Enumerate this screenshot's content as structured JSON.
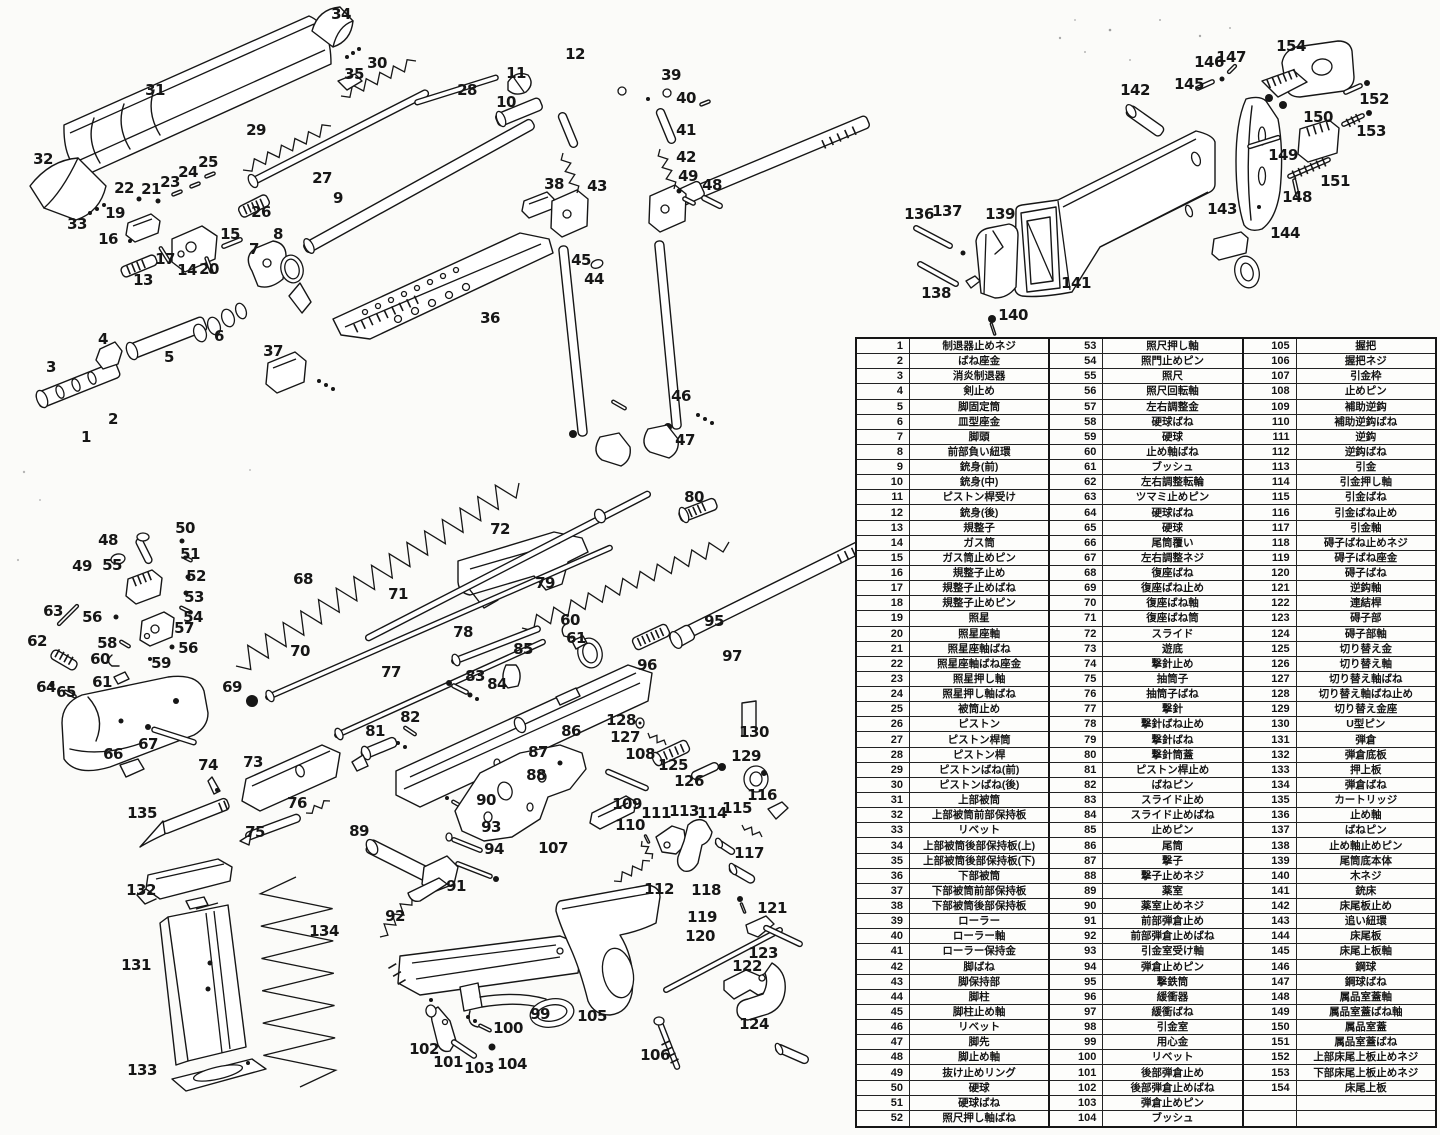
{
  "page": {
    "background": "#fbfbf9",
    "ink_color": "#161616"
  },
  "parts_table": {
    "columns": 3,
    "rows_per_column": 52,
    "empty_trailing_rows": 2,
    "entries": [
      "制退器止めネジ",
      "ばね座金",
      "消炎制退器",
      "剣止め",
      "脚固定筒",
      "皿型座金",
      "脚頭",
      "前部負い紐環",
      "銃身(前)",
      "銃身(中)",
      "ピストン桿受け",
      "銃身(後)",
      "規整子",
      "ガス筒",
      "ガス筒止めピン",
      "規整子止め",
      "規整子止めばね",
      "規整子止めピン",
      "照星",
      "照星座軸",
      "照星座軸ばね",
      "照星座軸ばね座金",
      "照星押し軸",
      "照星押し軸ばね",
      "被筒止め",
      "ピストン",
      "ピストン桿筒",
      "ピストン桿",
      "ピストンばね(前)",
      "ピストンばね(後)",
      "上部被筒",
      "上部被筒前部保持板",
      "リベット",
      "上部被筒後部保持板(上)",
      "上部被筒後部保持板(下)",
      "下部被筒",
      "下部被筒前部保持板",
      "下部被筒後部保持板",
      "ローラー",
      "ローラー軸",
      "ローラー保持金",
      "脚ばね",
      "脚保持部",
      "脚柱",
      "脚柱止め軸",
      "リベット",
      "脚先",
      "脚止め軸",
      "抜け止めリング",
      "硬球",
      "硬球ばね",
      "照尺押し軸ばね",
      "照尺押し軸",
      "照門止めピン",
      "照尺",
      "照尺回転軸",
      "左右調整金",
      "硬球ばね",
      "硬球",
      "止め軸ばね",
      "ブッシュ",
      "左右調整転輪",
      "ツマミ止めピン",
      "硬球ばね",
      "硬球",
      "尾筒覆い",
      "左右調整ネジ",
      "復座ばね",
      "復座ばね止め",
      "復座ばね軸",
      "復座ばね筒",
      "スライド",
      "遊底",
      "撃針止め",
      "抽筒子",
      "抽筒子ばね",
      "撃針",
      "撃針ばね止め",
      "撃針ばね",
      "撃針筒蓋",
      "ピストン桿止め",
      "ばねピン",
      "スライド止め",
      "スライド止めばね",
      "止めピン",
      "尾筒",
      "撃子",
      "撃子止めネジ",
      "薬室",
      "薬室止めネジ",
      "前部弾倉止め",
      "前部弾倉止めばね",
      "引金室受け軸",
      "弾倉止めピン",
      "撃鉄筒",
      "緩衝器",
      "緩衝ばね",
      "引金室",
      "用心金",
      "リベット",
      "後部弾倉止め",
      "後部弾倉止めばね",
      "弾倉止めピン",
      "ブッシュ",
      "握把",
      "握把ネジ",
      "引金枠",
      "止めピン",
      "補助逆鈎",
      "補助逆鈎ばね",
      "逆鈎",
      "逆鈎ばね",
      "引金",
      "引金押し軸",
      "引金ばね",
      "引金ばね止め",
      "引金軸",
      "碍子ばね止めネジ",
      "碍子ばね座金",
      "碍子ばね",
      "逆鈎軸",
      "連結桿",
      "碍子部",
      "碍子部軸",
      "切り替え金",
      "切り替え軸",
      "切り替え軸ばね",
      "切り替え軸ばね止め",
      "切り替え金座",
      "U型ピン",
      "弾倉",
      "弾倉底板",
      "押上板",
      "弾倉ばね",
      "カートリッジ",
      "止め軸",
      "ばねピン",
      "止め軸止めピン",
      "尾筒底本体",
      "木ネジ",
      "銃床",
      "床尾板止め",
      "追い紐環",
      "床尾板",
      "床尾上板軸",
      "鋼球",
      "鋼球ばね",
      "属品室蓋軸",
      "属品室蓋ばね軸",
      "属品室蓋",
      "属品室蓋ばね",
      "上部床尾上板止めネジ",
      "下部床尾上板止めネジ",
      "床尾上板"
    ]
  },
  "diagram": {
    "labels": [
      [
        1,
        86,
        437
      ],
      [
        2,
        113,
        419
      ],
      [
        3,
        51,
        367
      ],
      [
        4,
        103,
        339
      ],
      [
        5,
        169,
        357
      ],
      [
        6,
        219,
        336
      ],
      [
        7,
        254,
        249
      ],
      [
        8,
        278,
        234
      ],
      [
        9,
        338,
        198
      ],
      [
        10,
        506,
        102
      ],
      [
        11,
        516,
        73
      ],
      [
        12,
        575,
        54
      ],
      [
        13,
        143,
        280
      ],
      [
        14,
        187,
        270
      ],
      [
        15,
        230,
        234
      ],
      [
        16,
        108,
        239
      ],
      [
        17,
        165,
        259
      ],
      [
        19,
        115,
        213
      ],
      [
        20,
        209,
        269
      ],
      [
        21,
        151,
        189
      ],
      [
        22,
        124,
        188
      ],
      [
        23,
        170,
        182
      ],
      [
        24,
        188,
        172
      ],
      [
        25,
        208,
        162
      ],
      [
        26,
        261,
        212
      ],
      [
        27,
        322,
        178
      ],
      [
        28,
        467,
        90
      ],
      [
        29,
        256,
        130
      ],
      [
        30,
        377,
        63
      ],
      [
        31,
        155,
        90
      ],
      [
        32,
        43,
        159
      ],
      [
        33,
        77,
        224
      ],
      [
        34,
        341,
        14
      ],
      [
        35,
        354,
        74
      ],
      [
        36,
        490,
        318
      ],
      [
        37,
        273,
        351
      ],
      [
        38,
        554,
        184
      ],
      [
        39,
        671,
        75
      ],
      [
        40,
        686,
        98
      ],
      [
        41,
        686,
        130
      ],
      [
        42,
        686,
        157
      ],
      [
        43,
        597,
        186
      ],
      [
        44,
        594,
        279
      ],
      [
        45,
        581,
        260
      ],
      [
        46,
        681,
        396
      ],
      [
        47,
        685,
        440
      ],
      [
        48,
        712,
        185
      ],
      [
        49,
        688,
        176
      ],
      [
        136,
        919,
        214
      ],
      [
        137,
        947,
        211
      ],
      [
        138,
        936,
        293
      ],
      [
        139,
        1000,
        214
      ],
      [
        140,
        1013,
        315
      ],
      [
        141,
        1076,
        283
      ],
      [
        142,
        1135,
        90
      ],
      [
        143,
        1222,
        209
      ],
      [
        144,
        1285,
        233
      ],
      [
        145,
        1189,
        84
      ],
      [
        146,
        1209,
        62
      ],
      [
        147,
        1231,
        57
      ],
      [
        148,
        1297,
        197
      ],
      [
        149,
        1283,
        155
      ],
      [
        150,
        1318,
        117
      ],
      [
        151,
        1335,
        181
      ],
      [
        152,
        1374,
        99
      ],
      [
        153,
        1371,
        131
      ],
      [
        154,
        1291,
        46
      ],
      [
        48,
        108,
        540
      ],
      [
        49,
        82,
        566
      ],
      [
        50,
        185,
        528
      ],
      [
        51,
        190,
        554
      ],
      [
        52,
        196,
        576
      ],
      [
        53,
        194,
        597
      ],
      [
        54,
        193,
        617
      ],
      [
        55,
        112,
        565
      ],
      [
        56,
        92,
        617
      ],
      [
        56,
        188,
        648
      ],
      [
        57,
        184,
        628
      ],
      [
        58,
        107,
        643
      ],
      [
        59,
        161,
        663
      ],
      [
        60,
        100,
        659
      ],
      [
        60,
        570,
        620
      ],
      [
        61,
        102,
        682
      ],
      [
        61,
        576,
        638
      ],
      [
        62,
        37,
        641
      ],
      [
        63,
        53,
        611
      ],
      [
        64,
        46,
        687
      ],
      [
        65,
        66,
        692
      ],
      [
        66,
        113,
        754
      ],
      [
        67,
        148,
        744
      ],
      [
        68,
        303,
        579
      ],
      [
        69,
        232,
        687
      ],
      [
        70,
        300,
        651
      ],
      [
        71,
        398,
        594
      ],
      [
        72,
        500,
        529
      ],
      [
        73,
        253,
        762
      ],
      [
        74,
        208,
        765
      ],
      [
        75,
        255,
        832
      ],
      [
        76,
        297,
        803
      ],
      [
        77,
        391,
        672
      ],
      [
        78,
        463,
        632
      ],
      [
        79,
        545,
        583
      ],
      [
        80,
        694,
        497
      ],
      [
        81,
        375,
        731
      ],
      [
        82,
        410,
        717
      ],
      [
        83,
        475,
        676
      ],
      [
        84,
        497,
        684
      ],
      [
        85,
        523,
        649
      ],
      [
        86,
        571,
        731
      ],
      [
        87,
        538,
        752
      ],
      [
        88,
        536,
        775
      ],
      [
        89,
        359,
        831
      ],
      [
        90,
        486,
        800
      ],
      [
        91,
        456,
        886
      ],
      [
        92,
        395,
        916
      ],
      [
        93,
        491,
        827
      ],
      [
        94,
        494,
        849
      ],
      [
        95,
        714,
        621
      ],
      [
        96,
        647,
        665
      ],
      [
        97,
        732,
        656
      ],
      [
        99,
        540,
        1014
      ],
      [
        100,
        508,
        1028
      ],
      [
        101,
        448,
        1062
      ],
      [
        102,
        424,
        1049
      ],
      [
        103,
        479,
        1068
      ],
      [
        104,
        512,
        1064
      ],
      [
        105,
        592,
        1016
      ],
      [
        106,
        655,
        1055
      ],
      [
        107,
        553,
        848
      ],
      [
        108,
        640,
        754
      ],
      [
        109,
        627,
        804
      ],
      [
        110,
        630,
        825
      ],
      [
        111,
        656,
        813
      ],
      [
        112,
        659,
        889
      ],
      [
        113,
        684,
        811
      ],
      [
        114,
        712,
        813
      ],
      [
        115,
        737,
        808
      ],
      [
        116,
        762,
        795
      ],
      [
        117,
        749,
        853
      ],
      [
        118,
        706,
        890
      ],
      [
        119,
        702,
        917
      ],
      [
        120,
        700,
        936
      ],
      [
        121,
        772,
        908
      ],
      [
        122,
        747,
        966
      ],
      [
        123,
        763,
        953
      ],
      [
        124,
        754,
        1024
      ],
      [
        125,
        673,
        765
      ],
      [
        126,
        689,
        781
      ],
      [
        127,
        625,
        737
      ],
      [
        128,
        621,
        720
      ],
      [
        129,
        746,
        756
      ],
      [
        130,
        754,
        732
      ],
      [
        131,
        136,
        965
      ],
      [
        132,
        141,
        890
      ],
      [
        133,
        142,
        1070
      ],
      [
        134,
        324,
        931
      ],
      [
        135,
        142,
        813
      ]
    ]
  }
}
